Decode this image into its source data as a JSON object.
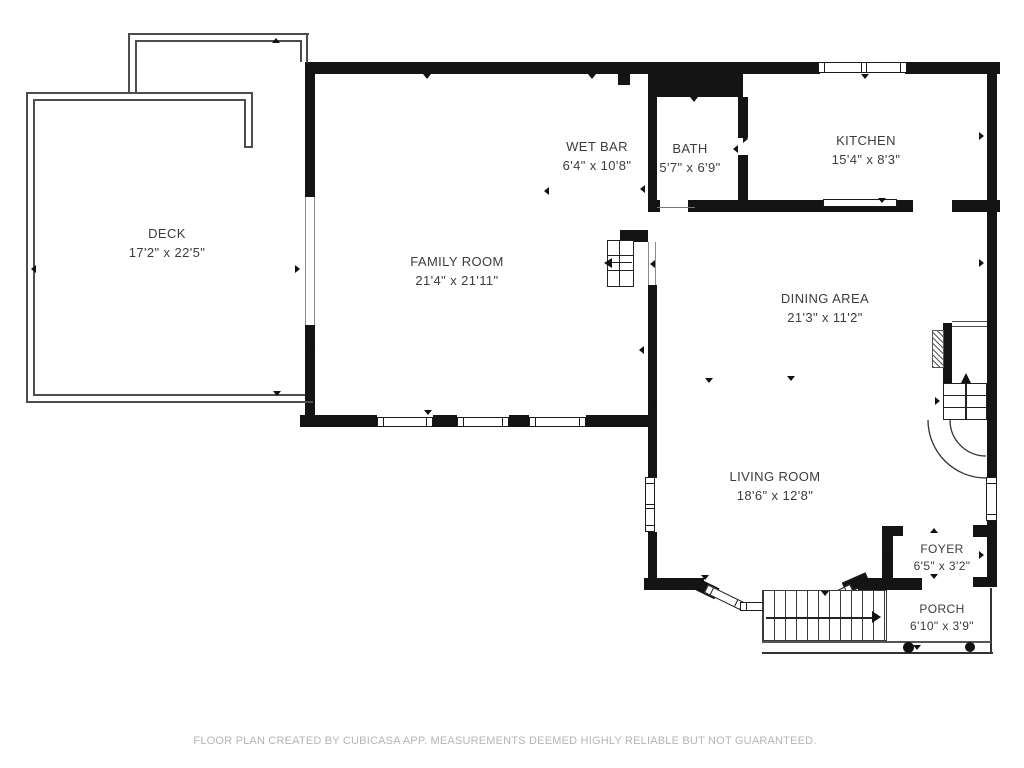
{
  "footer": {
    "text": "FLOOR PLAN CREATED BY CUBICASA APP. MEASUREMENTS DEEMED HIGHLY RELIABLE BUT NOT GUARANTEED."
  },
  "rooms": [
    {
      "id": "deck",
      "name": "DECK",
      "dimensions": "17'2\" x 22'5\""
    },
    {
      "id": "family-room",
      "name": "FAMILY ROOM",
      "dimensions": "21'4\" x 21'11\""
    },
    {
      "id": "wet-bar",
      "name": "WET BAR",
      "dimensions": "6'4\" x 10'8\""
    },
    {
      "id": "bath",
      "name": "BATH",
      "dimensions": "5'7\" x 6'9\""
    },
    {
      "id": "kitchen",
      "name": "KITCHEN",
      "dimensions": "15'4\" x 8'3\""
    },
    {
      "id": "dining-area",
      "name": "DINING AREA",
      "dimensions": "21'3\" x 11'2\""
    },
    {
      "id": "living-room",
      "name": "LIVING ROOM",
      "dimensions": "18'6\" x 12'8\""
    },
    {
      "id": "foyer",
      "name": "FOYER",
      "dimensions": "6'5\" x 3'2\""
    },
    {
      "id": "porch",
      "name": "PORCH",
      "dimensions": "6'10\" x 3'9\""
    }
  ],
  "colors": {
    "wall": "#141414",
    "thin_line": "#4d4d4d",
    "label_text": "#3c3c3c",
    "footer_text": "#b4b4b4",
    "background": "#ffffff"
  }
}
